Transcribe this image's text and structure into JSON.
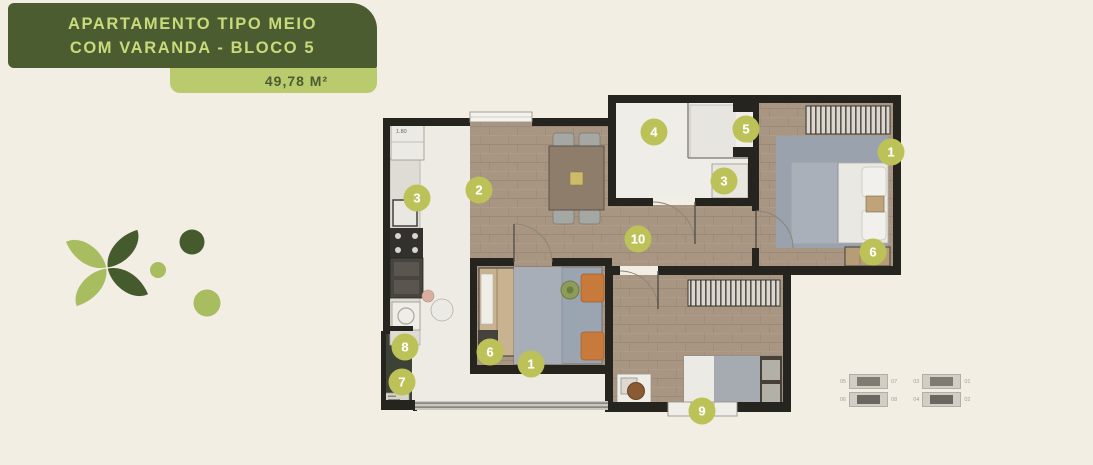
{
  "header": {
    "title_line1": "APARTAMENTO TIPO MEIO",
    "title_line2": "COM VARANDA - BLOCO 5",
    "area_label": "49,78 M²"
  },
  "colors": {
    "background": "#f3eee3",
    "title_bg": "#4c5c31",
    "title_text": "#c9da7a",
    "area_bg": "#b9cb6d",
    "marker": "#bcc257",
    "marker_text": "#ffffff",
    "wall": "#26241f",
    "wood_floor": "#a89682",
    "tile_floor": "#edebe4",
    "planter": "#3c4336",
    "logo_light": "#a7bd60",
    "logo_dark": "#455a2d"
  },
  "floorplan": {
    "dimension_label": "1.80",
    "markers": [
      {
        "label": "2"
      },
      {
        "label": "3"
      },
      {
        "label": "4"
      },
      {
        "label": "5"
      },
      {
        "label": "3"
      },
      {
        "label": "1"
      },
      {
        "label": "6"
      },
      {
        "label": "10"
      },
      {
        "label": "8"
      },
      {
        "label": "7"
      },
      {
        "label": "6"
      },
      {
        "label": "1"
      },
      {
        "label": "9"
      }
    ]
  },
  "keyplan": {
    "left_unit_labels": [
      "05",
      "07",
      "06",
      "08"
    ],
    "right_unit_labels": [
      "03",
      "01",
      "04",
      "02"
    ]
  }
}
